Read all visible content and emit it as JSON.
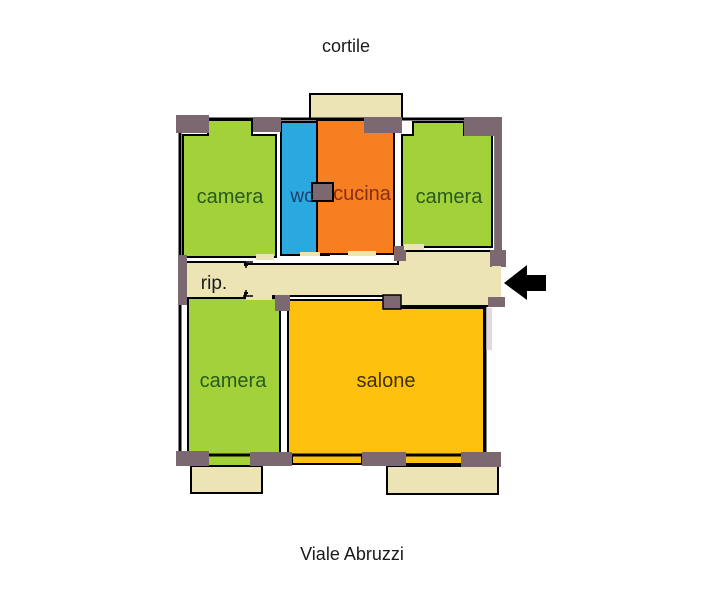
{
  "plan": {
    "outside_top_label": "cortile",
    "outside_bottom_label": "Viale Abruzzi",
    "rooms": {
      "camera_top_left": {
        "label": "camera"
      },
      "wc": {
        "label": "wc"
      },
      "cucina": {
        "label": "cucina"
      },
      "camera_top_right": {
        "label": "camera"
      },
      "rip": {
        "label": "rip."
      },
      "camera_bottom_left": {
        "label": "camera"
      },
      "salone": {
        "label": "salone"
      }
    }
  },
  "colors": {
    "camera_fill": "#a3d139",
    "wc_fill": "#2aa9e1",
    "cucina_fill": "#f57f21",
    "salone_fill": "#fec10d",
    "beige_fill": "#ece4b5",
    "wall_accent": "#7c6870",
    "arrow_black": "#000000",
    "camera_text": "#275a1b",
    "wc_text": "#1c3f67",
    "cucina_text": "#8a2c18",
    "salone_text": "#403109",
    "plain_text": "#1a1a1a"
  }
}
